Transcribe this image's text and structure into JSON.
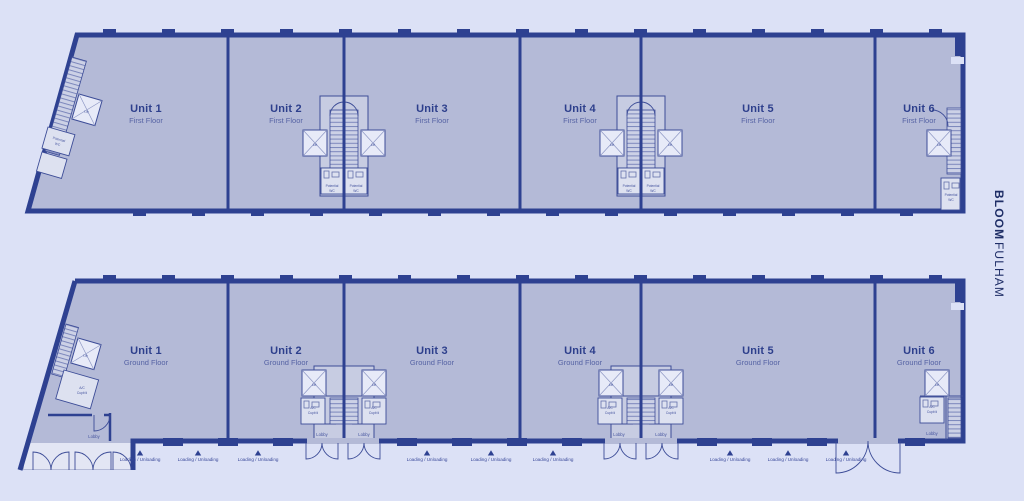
{
  "brand": {
    "primary": "BLOOM",
    "secondary": "FULHAM"
  },
  "palette": {
    "background": "#dce1f6",
    "floor_fill": "#b4bad7",
    "wall": "#2e4191",
    "room_fill": "#c7cce2",
    "light_room_fill": "#e7eaf8",
    "title_text": "#2d3f8c",
    "subtitle_text": "#5663a4",
    "brand_text": "#1e2d66"
  },
  "first_floor": {
    "units": [
      {
        "title": "Unit 1",
        "subtitle": "First Floor"
      },
      {
        "title": "Unit 2",
        "subtitle": "First Floor"
      },
      {
        "title": "Unit 3",
        "subtitle": "First Floor"
      },
      {
        "title": "Unit 4",
        "subtitle": "First Floor"
      },
      {
        "title": "Unit 5",
        "subtitle": "First Floor"
      },
      {
        "title": "Unit 6",
        "subtitle": "First Floor"
      }
    ]
  },
  "ground_floor": {
    "units": [
      {
        "title": "Unit 1",
        "subtitle": "Ground Floor"
      },
      {
        "title": "Unit 2",
        "subtitle": "Ground Floor"
      },
      {
        "title": "Unit 3",
        "subtitle": "Ground Floor"
      },
      {
        "title": "Unit 4",
        "subtitle": "Ground Floor"
      },
      {
        "title": "Unit 5",
        "subtitle": "Ground Floor"
      },
      {
        "title": "Unit 6",
        "subtitle": "Ground Floor"
      }
    ]
  },
  "labels": {
    "lift": "Lift",
    "lobby": "Lobby",
    "loading": "Loading / Unloading",
    "potential_wc_line1": "Potential",
    "potential_wc_line2": "WC",
    "cupboard_line1": "A/C",
    "cupboard_line2": "Cupb'd"
  }
}
